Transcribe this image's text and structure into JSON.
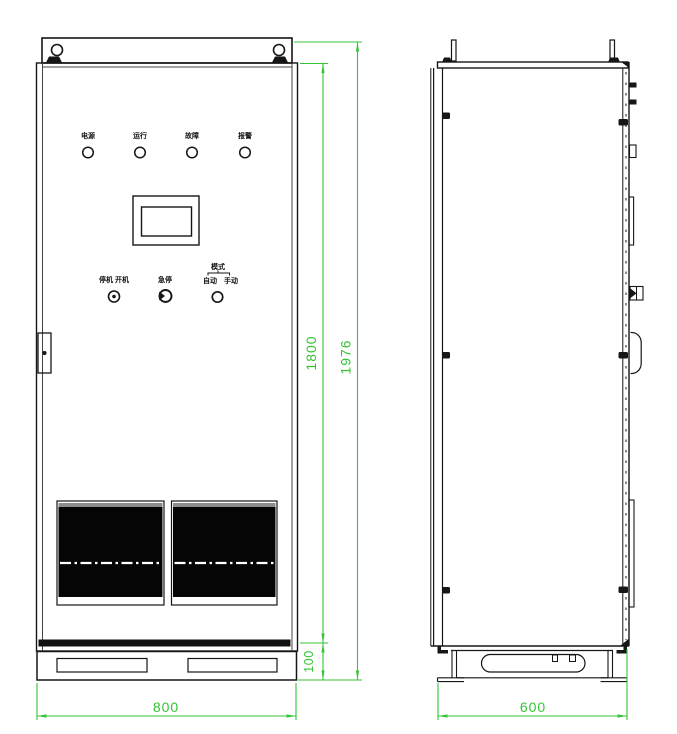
{
  "drawing": {
    "type": "cabinet-outline-drawing",
    "views": [
      "front",
      "side"
    ]
  },
  "dimensions": {
    "front_width": "800",
    "side_depth": "600",
    "cabinet_height": "1800",
    "overall_height": "1976",
    "base_height": "100"
  },
  "front_panel": {
    "indicator_labels": [
      "电源",
      "运行",
      "故障",
      "报警"
    ],
    "controls": {
      "power_switch_label": "停机 开机",
      "estop_label": "急停",
      "mode_label": "模式",
      "mode_option_left": "自动",
      "mode_option_right": "手动"
    }
  },
  "colors": {
    "line": "#161616",
    "dimension_green": "#35c435",
    "grille_fill": "#050505",
    "background": "#ffffff"
  }
}
